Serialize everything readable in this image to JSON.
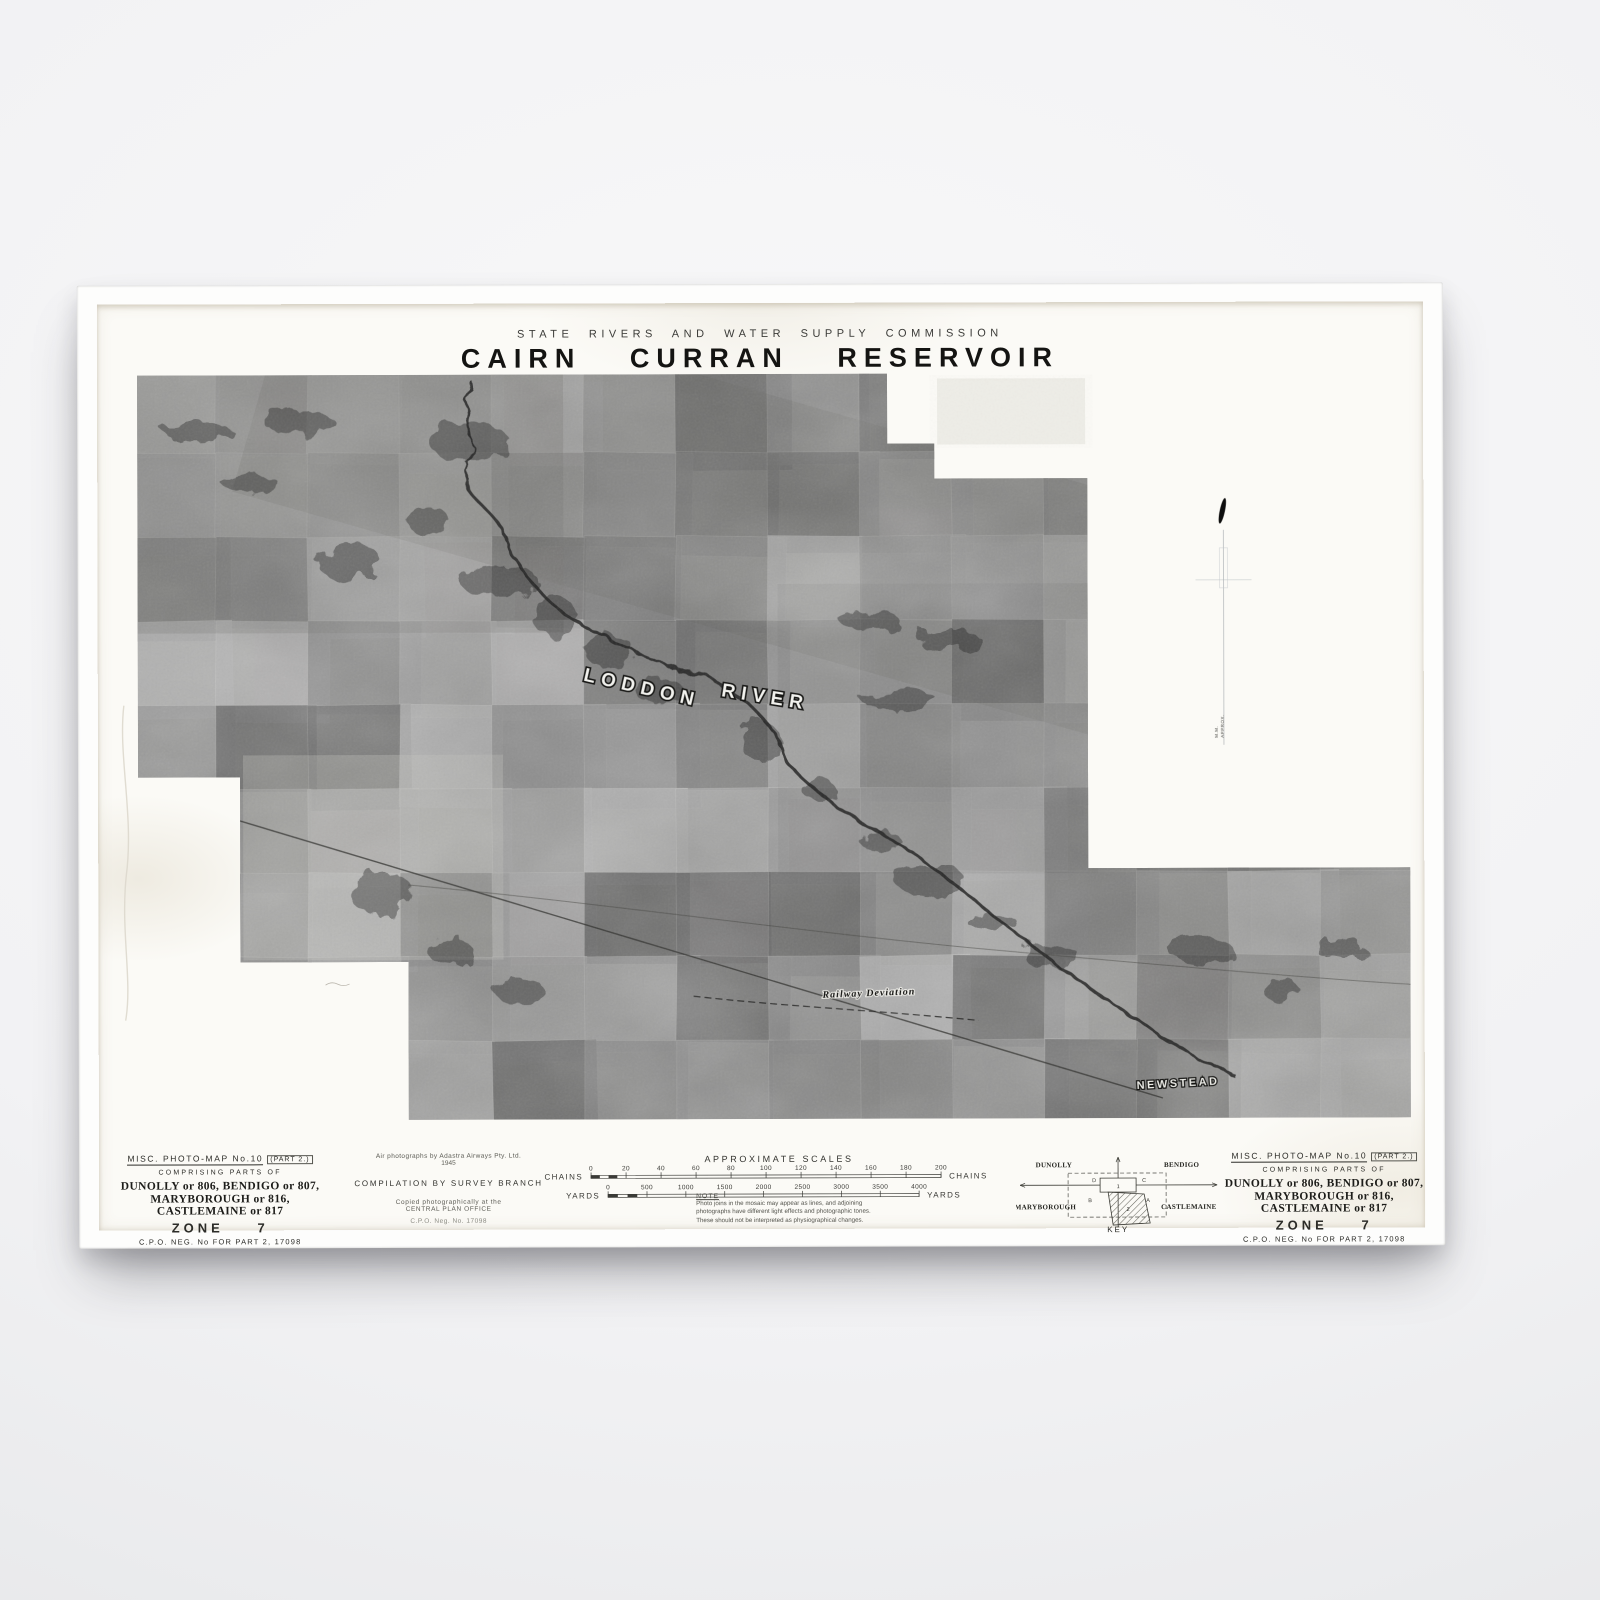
{
  "poster": {
    "agency_line": "STATE RIVERS AND WATER SUPPLY COMMISSION",
    "title": "CAIRN CURRAN RESERVOIR"
  },
  "map_labels": {
    "river_word1": "LODDON",
    "river_word2": "RIVER",
    "railway_deviation": "Railway Deviation",
    "town": "NEWSTEAD",
    "margin_mark_1": "M.M.",
    "margin_mark_2": "APPROX."
  },
  "sheet_info": {
    "series_title": "MISC. PHOTO-MAP No.10",
    "part": "(PART 2.)",
    "comprising": "COMPRISING PARTS OF",
    "sheets_line1": "DUNOLLY or 806, BENDIGO or 807,",
    "sheets_line2": "MARYBOROUGH or 816, CASTLEMAINE or 817",
    "zone_label": "ZONE",
    "zone_number": "7",
    "neg_line": "C.P.O. NEG. No FOR PART 2, 17098"
  },
  "credits": {
    "air_photo_line1": "Air photographs by Adastra Airways Pty. Ltd.",
    "air_photo_line2": "1945",
    "compilation": "COMPILATION BY SURVEY BRANCH",
    "copied_line1": "Copied photographically at the",
    "copied_line2": "CENTRAL PLAN OFFICE",
    "neg_small": "C.P.O. Neg. No. 17098"
  },
  "scales": {
    "title": "APPROXIMATE SCALES",
    "chains": {
      "unit": "CHAINS",
      "ticks": [
        "0",
        "20",
        "40",
        "60",
        "80",
        "100",
        "120",
        "140",
        "160",
        "180",
        "200"
      ]
    },
    "yards": {
      "unit": "YARDS",
      "ticks": [
        "0",
        "500",
        "1000",
        "1500",
        "2000",
        "2500",
        "3000",
        "3500",
        "4000"
      ]
    }
  },
  "note": {
    "title": "NOTE",
    "lines": [
      "Photo joins in the mosaic may appear as lines, and adjoining",
      "photographs have different light effects and photographic tones.",
      "These should not be interpreted as physiographical changes."
    ]
  },
  "key": {
    "title": "KEY",
    "corner_nw": "DUNOLLY",
    "corner_ne": "BENDIGO",
    "corner_sw": "MARYBOROUGH",
    "corner_se": "CASTLEMAINE",
    "quadrants": [
      "D",
      "C",
      "B",
      "A"
    ],
    "sheet_current": "1",
    "sheet_part2": "2"
  },
  "colors": {
    "paper": "#fbfaf6",
    "frame_white": "#fdfdfc",
    "ink": "#22221f",
    "mosaic_mid": "#9b9a97"
  }
}
